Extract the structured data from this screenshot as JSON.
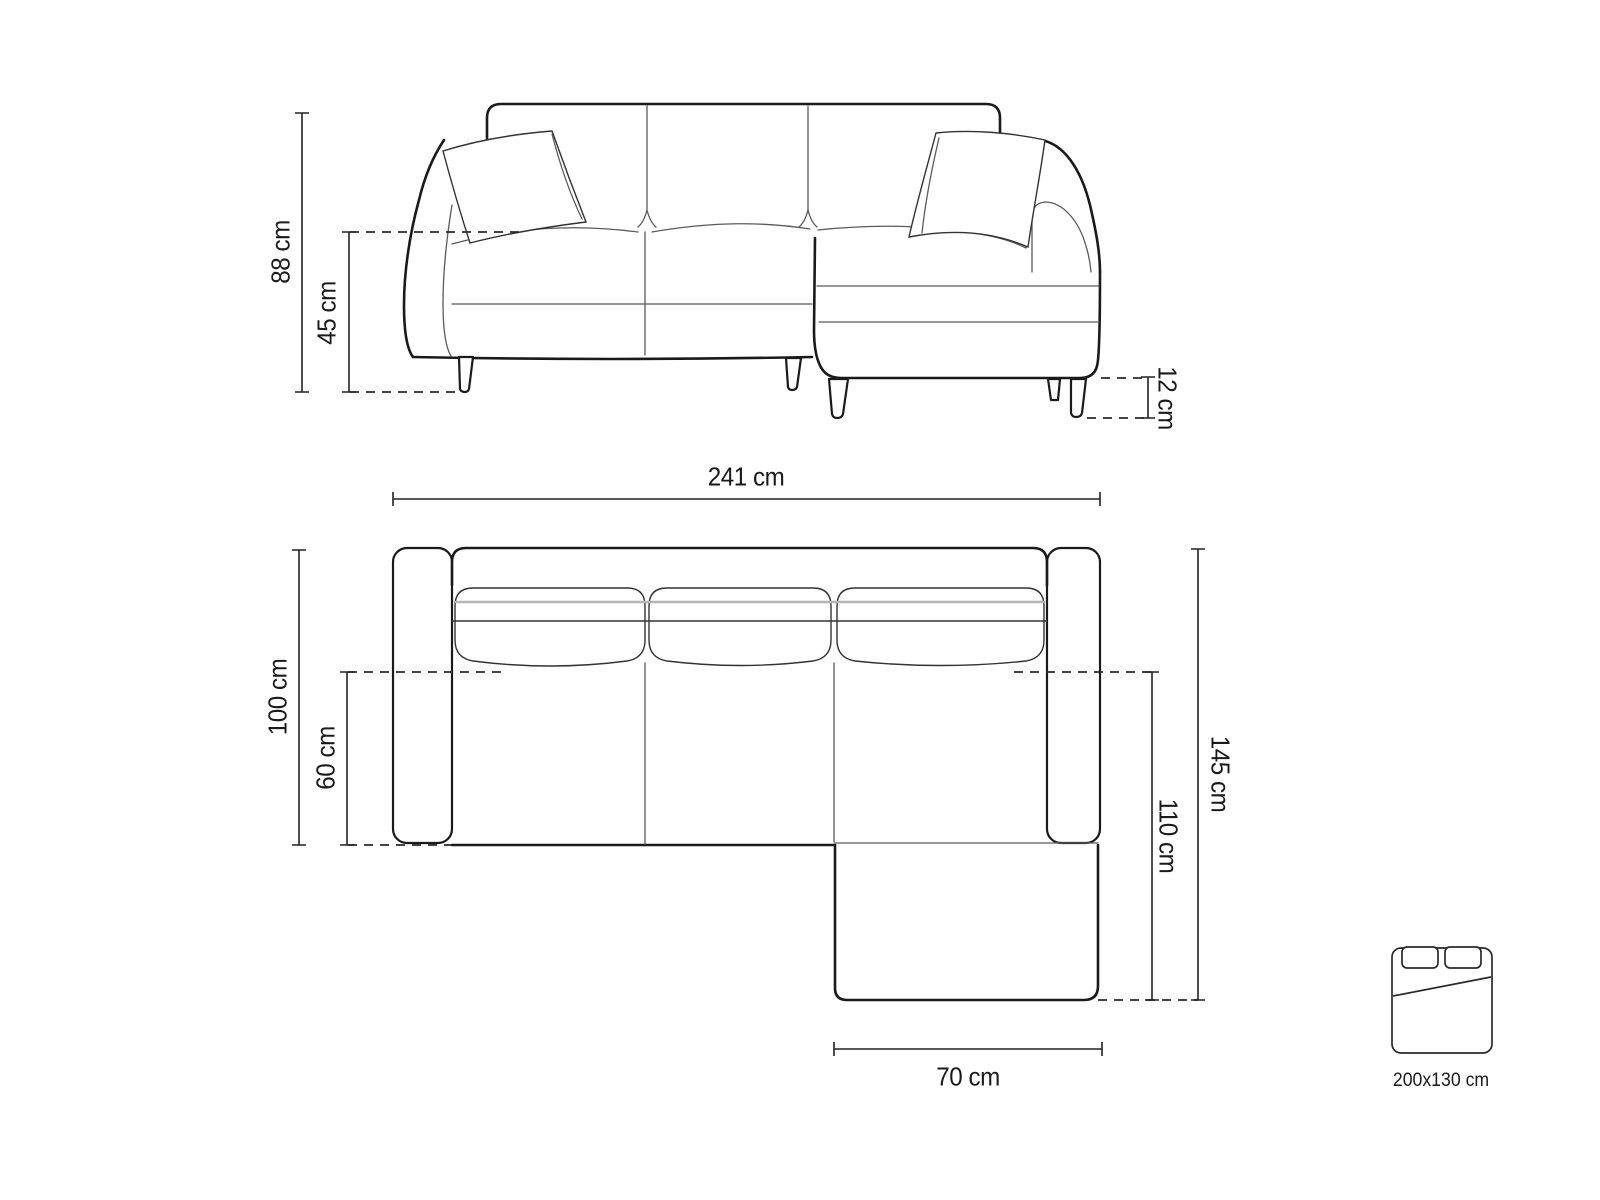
{
  "front_view": {
    "dimensions": {
      "total_height": "88 cm",
      "seat_height": "45 cm",
      "leg_height": "12 cm"
    }
  },
  "top_view": {
    "dimensions": {
      "total_width": "241 cm",
      "body_depth": "100 cm",
      "seat_depth": "60 cm",
      "chaise_total_depth": "145 cm",
      "chaise_inner_depth": "110 cm",
      "chaise_width": "70 cm"
    }
  },
  "sleeping_area": {
    "icon": "bed-icon",
    "label": "200x130 cm"
  },
  "colors": {
    "background": "#ffffff",
    "outline": "#1a1a1a",
    "detail": "#5a5a5a",
    "dimension": "#222222"
  }
}
